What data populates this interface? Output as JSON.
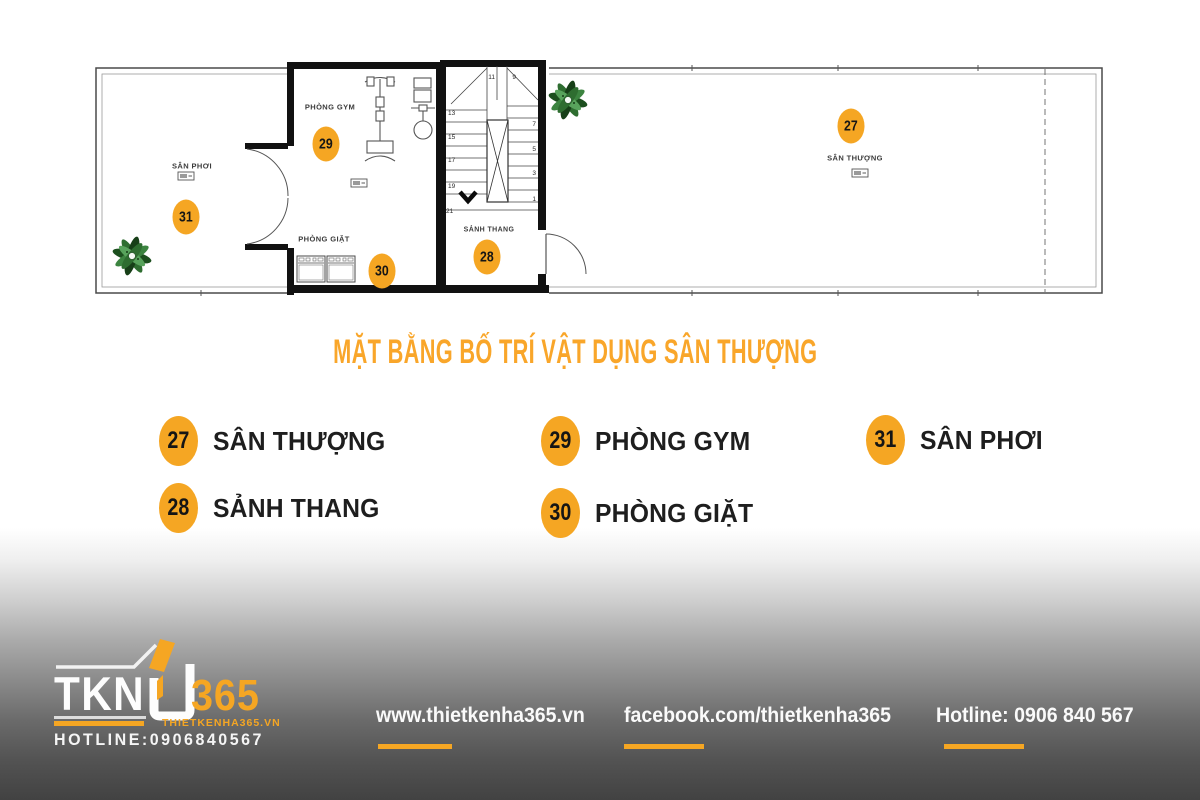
{
  "title": {
    "text": "MẶT BẰNG BỐ TRÍ VẬT DỤNG SÂN THƯỢNG"
  },
  "plan": {
    "rooms": {
      "san_phoi": "SÂN PHƠI",
      "phong_gym": "PHÒNG GYM",
      "phong_giat": "PHÒNG GIẶT",
      "sanh_thang": "SẢNH THANG",
      "san_thuong": "SÂN THƯỢNG"
    },
    "badges": {
      "san_thuong": "27",
      "sanh_thang": "28",
      "phong_gym": "29",
      "phong_giat": "30",
      "san_phoi": "31"
    },
    "stairs": {
      "numbers": [
        "11",
        "9",
        "13",
        "15",
        "17",
        "19",
        "21",
        "7",
        "5",
        "3",
        "1"
      ]
    }
  },
  "legend": {
    "items": [
      {
        "num": "27",
        "label": "SÂN THƯỢNG"
      },
      {
        "num": "28",
        "label": "SẢNH THANG"
      },
      {
        "num": "29",
        "label": "PHÒNG GYM"
      },
      {
        "num": "30",
        "label": "PHÒNG GIẶT"
      },
      {
        "num": "31",
        "label": "SÂN PHƠI"
      }
    ]
  },
  "footer": {
    "logo": {
      "name": "TKN",
      "number": "365",
      "website": "THIETKENHA365.VN",
      "hotline": "HOTLINE:0906840567"
    },
    "links": [
      {
        "label": "www.thietkenha365.vn"
      },
      {
        "label": "facebook.com/thietkenha365"
      },
      {
        "label": "Hotline: 0906 840 567"
      }
    ]
  },
  "colors": {
    "accent": "#F5A623",
    "title_orange": "#F9A62A",
    "legend_text": "#1E1E1E",
    "wall_black": "#111111",
    "footer_dark": "#424242"
  }
}
